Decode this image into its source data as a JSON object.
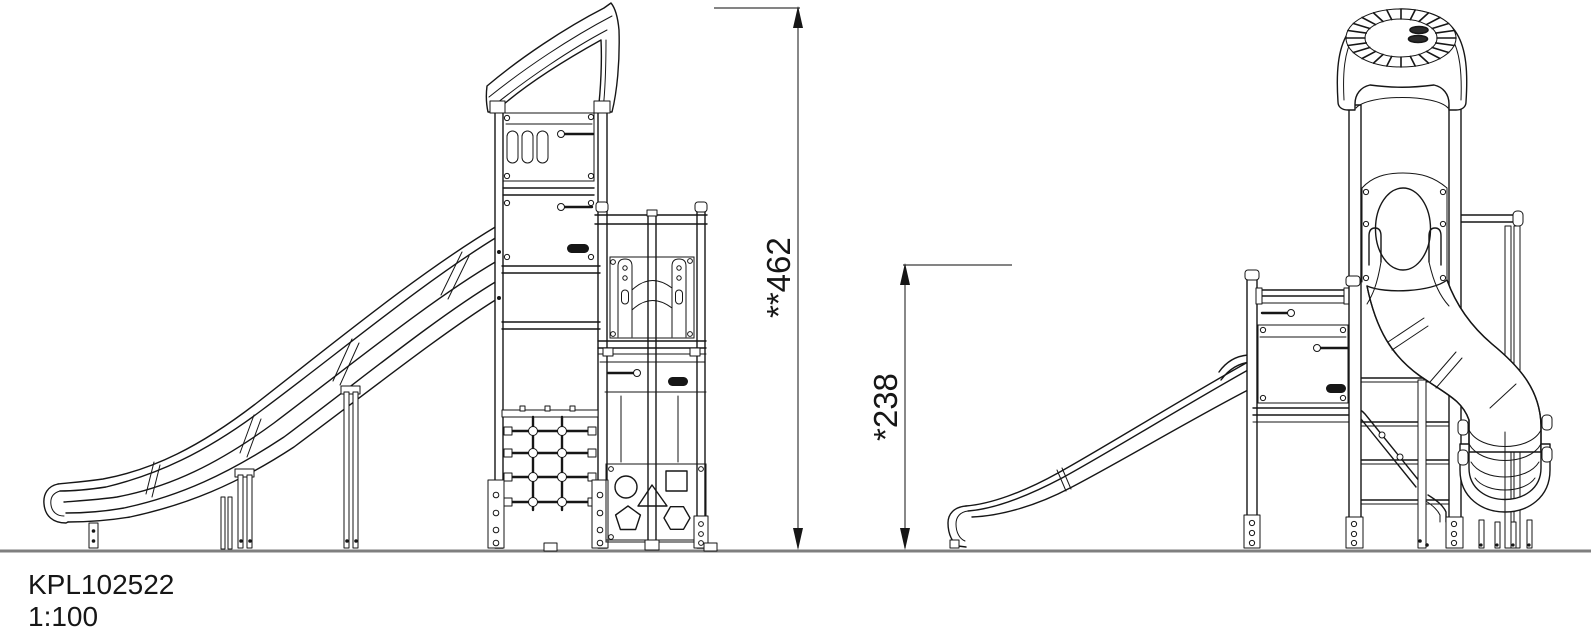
{
  "drawing": {
    "code": "KPL102522",
    "scale": "1:100"
  },
  "dimensions": {
    "overall_height": {
      "label": "**462",
      "value": 462,
      "prefix": "**"
    },
    "platform_height": {
      "label": "*238",
      "value": 238,
      "prefix": "*"
    }
  },
  "colors": {
    "line": "#161616",
    "ground": "#7f7f7f",
    "background": "#ffffff"
  },
  "views": {
    "left_elevation": {
      "components": [
        "curved-roof",
        "upper-panel-with-slots",
        "panel-handle",
        "wave-slide",
        "slide-support-legs",
        "climbing-net",
        "arch-tunnel-panel",
        "activity-shape-panel",
        "post-anchors"
      ]
    },
    "right_elevation": {
      "components": [
        "round-topper-roof",
        "tube-slide-entry-panel",
        "spiral-tube-slide",
        "straight-slide",
        "platform-panel-with-handle",
        "ladder-rungs",
        "handrail",
        "rear-post",
        "post-anchors"
      ]
    }
  }
}
